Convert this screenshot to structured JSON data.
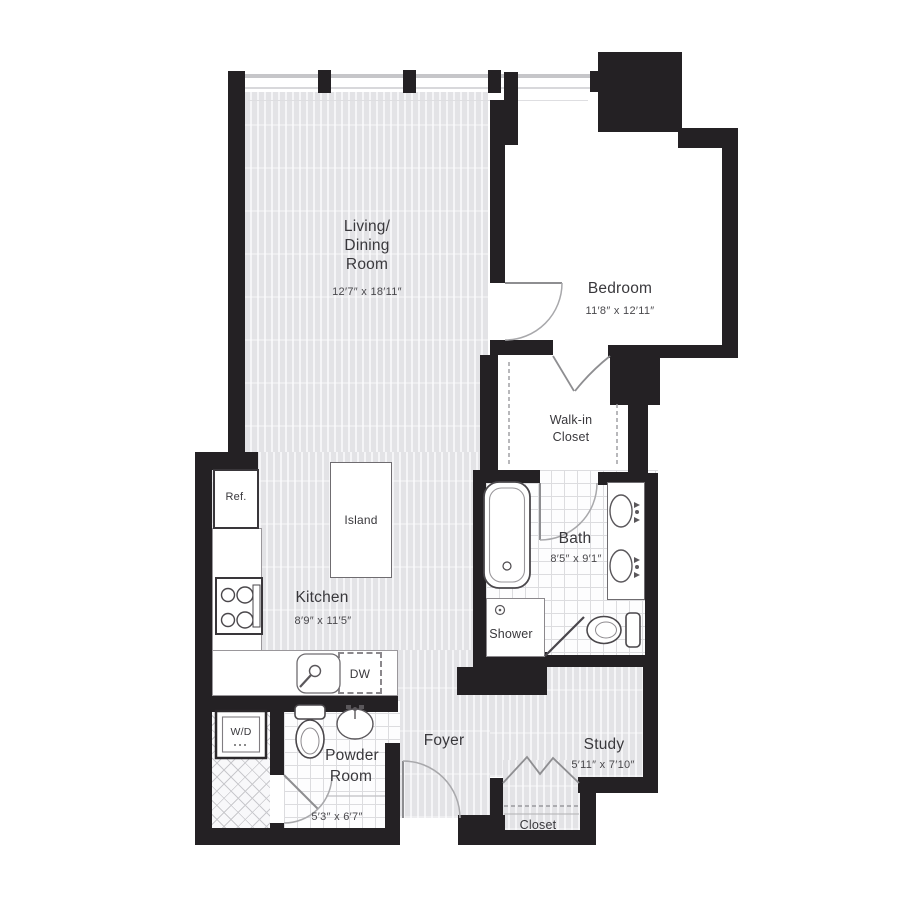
{
  "rooms": {
    "living": {
      "line1": "Living/",
      "line2": "Dining",
      "line3": "Room",
      "dims": "12′7″ x 18′11″"
    },
    "bedroom": {
      "name": "Bedroom",
      "dims": "11′8″ x 12′11″"
    },
    "walkin": {
      "line1": "Walk-in",
      "line2": "Closet"
    },
    "bath": {
      "name": "Bath",
      "dims": "8′5″ x 9′1″"
    },
    "kitchen": {
      "name": "Kitchen",
      "dims": "8′9″ x 11′5″"
    },
    "shower": {
      "name": "Shower"
    },
    "powder": {
      "line1": "Powder",
      "line2": "Room",
      "dims": "5′3″ x 6′7″"
    },
    "foyer": {
      "name": "Foyer"
    },
    "study": {
      "name": "Study",
      "dims": "5′11″ x 7′10″"
    },
    "closet": {
      "name": "Closet"
    }
  },
  "fixtures": {
    "refrigerator": "Ref.",
    "island": "Island",
    "dishwasher": "DW",
    "washer_dryer": "W/D"
  },
  "colors": {
    "wall": "#242124",
    "plank": "#e6e6e9",
    "door_arc": "#a6a6a9",
    "fixture_stroke": "#4a474b"
  }
}
